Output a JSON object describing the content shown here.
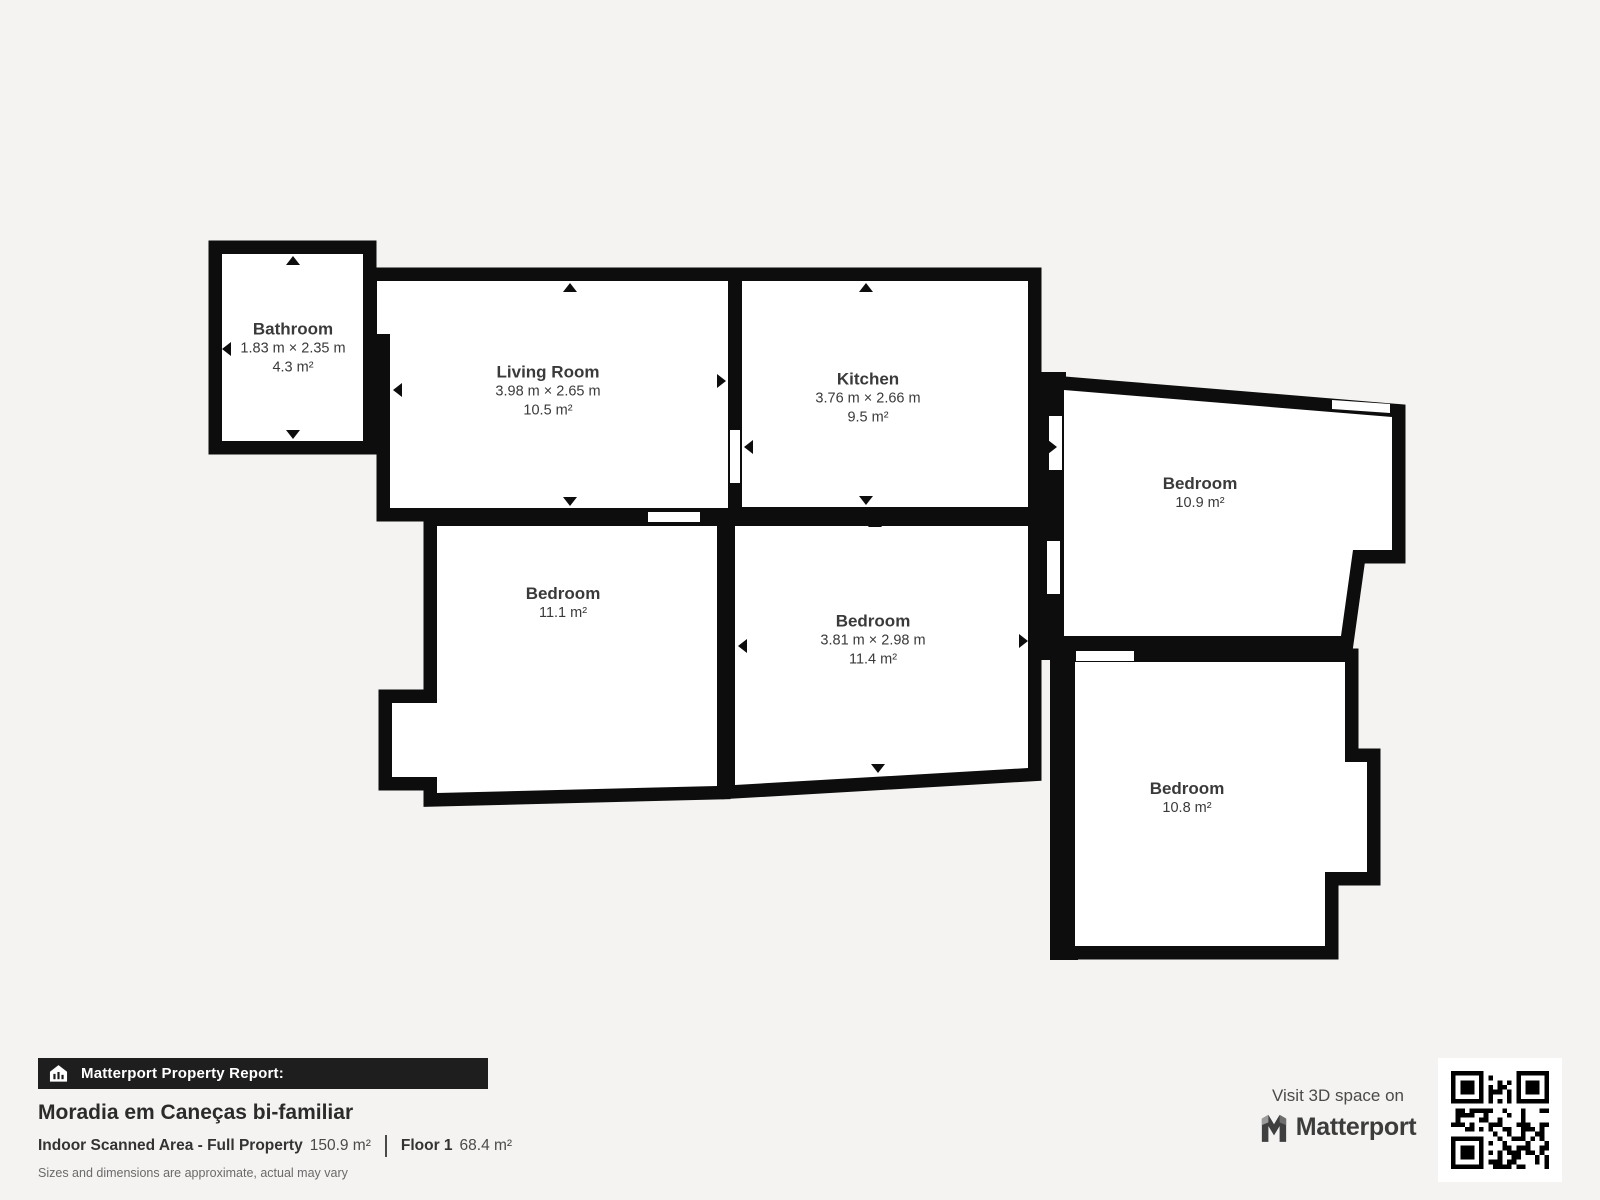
{
  "colors": {
    "background": "#f4f3f1",
    "wall": "#0d0d0d",
    "room_fill": "#ffffff",
    "room_text": "#3a3a3a",
    "banner_bg": "#1e1e1e"
  },
  "rooms": [
    {
      "name": "Bathroom",
      "dims": "1.83 m × 2.35 m",
      "area": "4.3 m²"
    },
    {
      "name": "Living Room",
      "dims": "3.98 m × 2.65 m",
      "area": "10.5 m²"
    },
    {
      "name": "Kitchen",
      "dims": "3.76 m × 2.66 m",
      "area": "9.5 m²"
    },
    {
      "name": "Bedroom",
      "area": "10.9 m²"
    },
    {
      "name": "Bedroom",
      "area": "11.1 m²"
    },
    {
      "name": "Bedroom",
      "dims": "3.81 m × 2.98 m",
      "area": "11.4 m²"
    },
    {
      "name": "Bedroom",
      "area": "10.8 m²"
    }
  ],
  "report": {
    "banner_label": "Matterport Property Report:",
    "property_title": "Moradia em Caneças bi-familiar",
    "area_label": "Indoor Scanned Area - Full Property",
    "area_value": "150.9 m²",
    "floor_label": "Floor 1",
    "floor_value": "68.4 m²",
    "disclaimer": "Sizes and dimensions are approximate, actual may vary"
  },
  "cta": {
    "visit_text": "Visit 3D space on",
    "brand": "Matterport"
  }
}
